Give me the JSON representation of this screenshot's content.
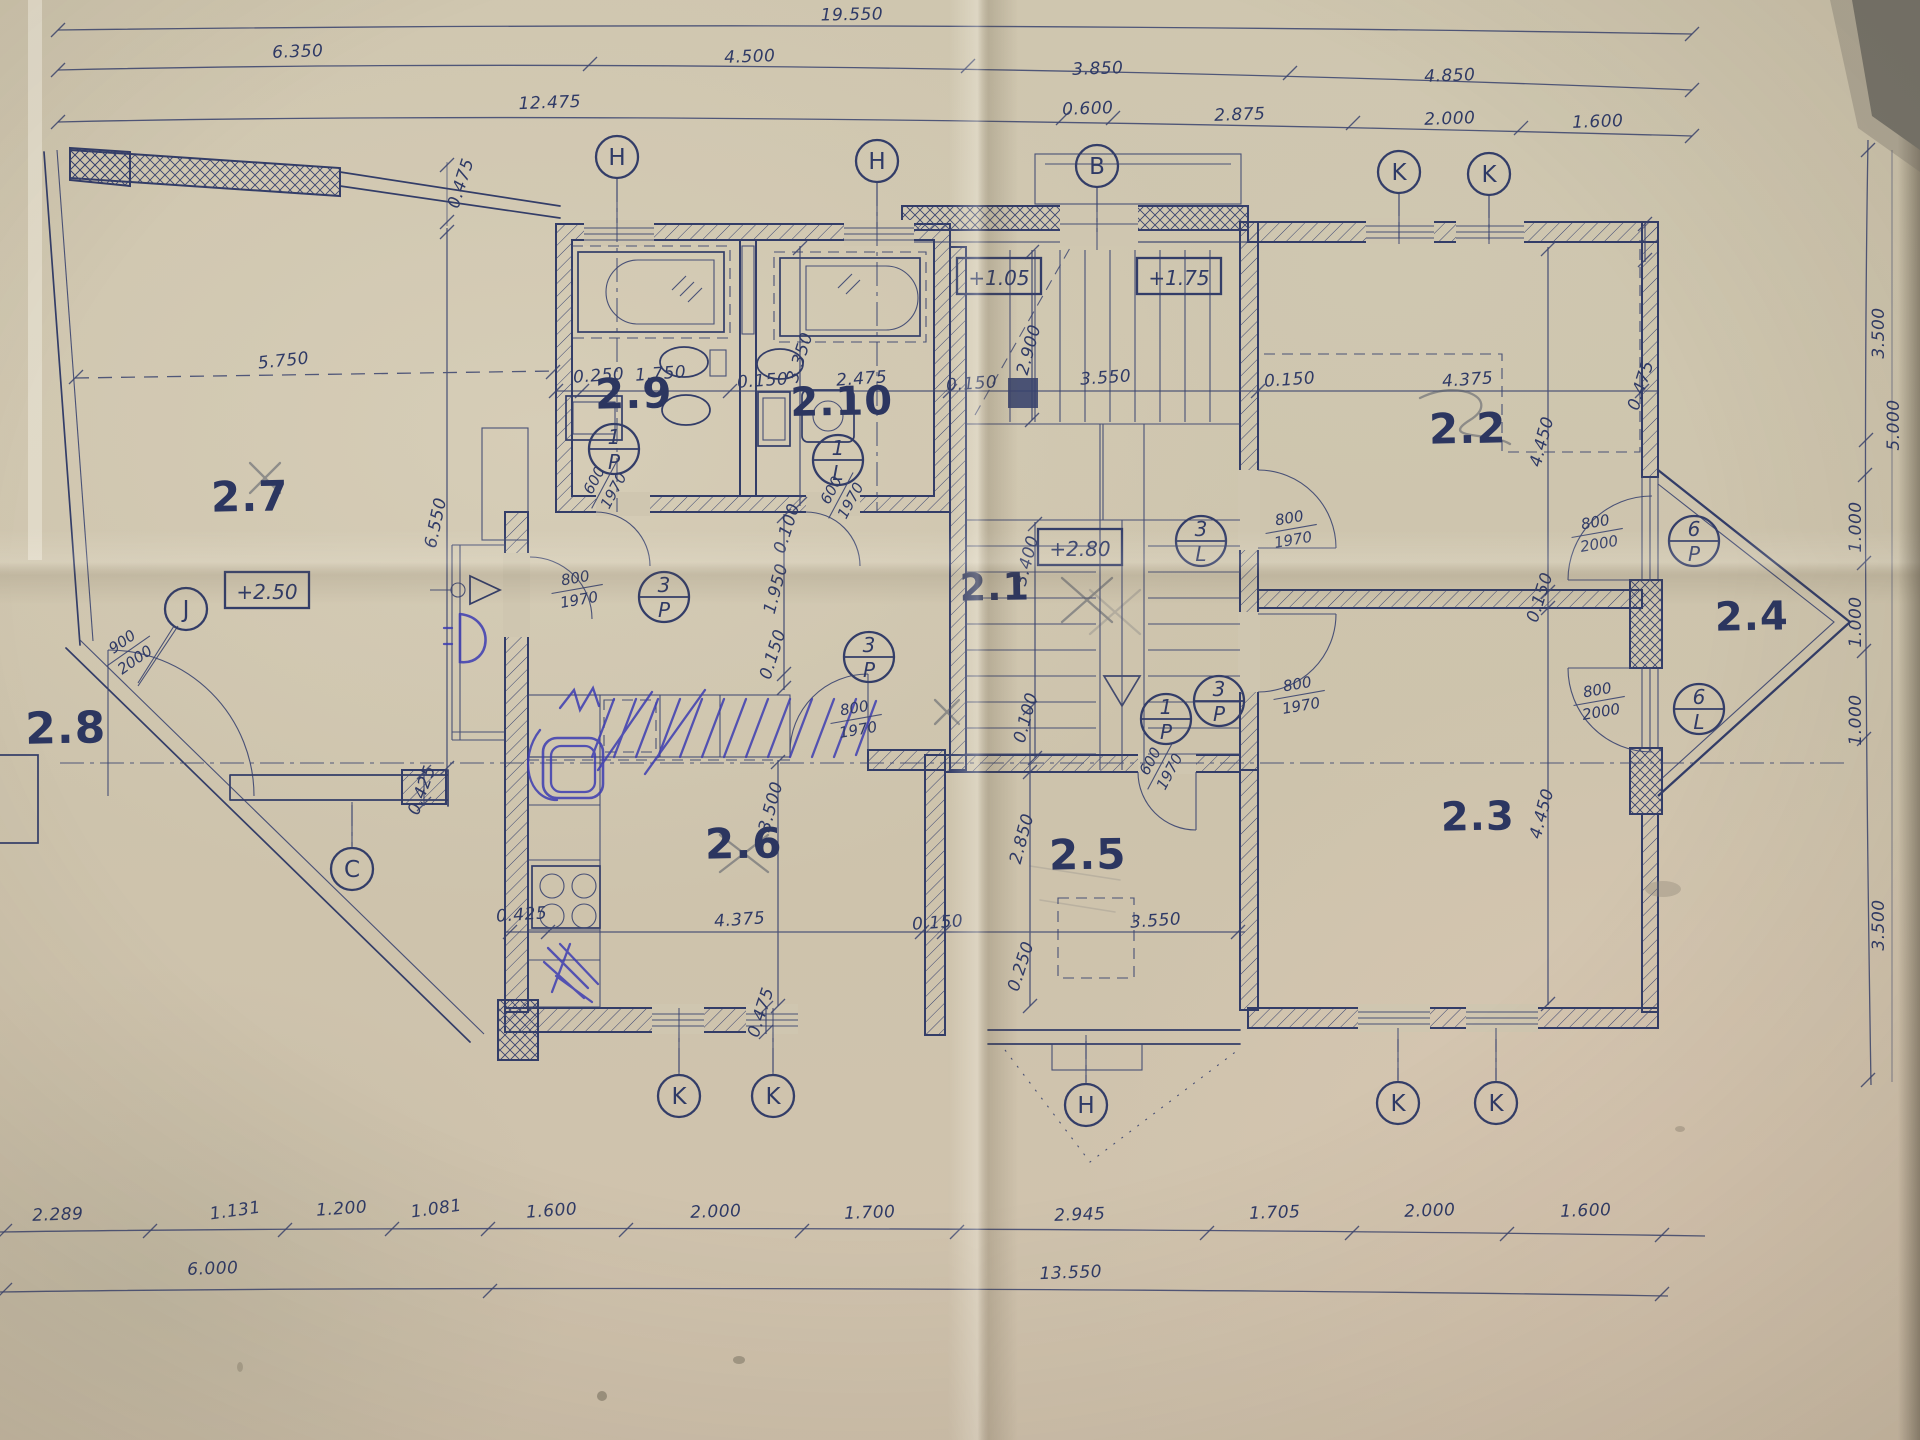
{
  "drawing": {
    "type": "architectural floor plan – storey 2, hand-drafted blueprint on aged paper",
    "ink_color": "#333d68",
    "paper_color": "#cdc4ae",
    "pen_annotation_color": "#3d3db2",
    "pencil_annotation_color": "#565b68"
  },
  "room_labels": [
    {
      "id": "2.1",
      "x": 995,
      "y": 600,
      "size": 38
    },
    {
      "id": "2.2",
      "x": 1468,
      "y": 443,
      "size": 42
    },
    {
      "id": "2.3",
      "x": 1478,
      "y": 830,
      "size": 40
    },
    {
      "id": "2.4",
      "x": 1752,
      "y": 630,
      "size": 40
    },
    {
      "id": "2.5",
      "x": 1088,
      "y": 869,
      "size": 42
    },
    {
      "id": "2.6",
      "x": 744,
      "y": 858,
      "size": 42
    },
    {
      "id": "2.7",
      "x": 250,
      "y": 511,
      "size": 42
    },
    {
      "id": "2.8",
      "x": 66,
      "y": 743,
      "size": 44
    },
    {
      "id": "2.9",
      "x": 634,
      "y": 408,
      "size": 42
    },
    {
      "id": "2.10",
      "x": 842,
      "y": 415,
      "size": 40
    }
  ],
  "grid_markers": [
    {
      "label": "H",
      "x": 617,
      "y": 157,
      "stem": "down"
    },
    {
      "label": "H",
      "x": 877,
      "y": 161,
      "stem": "down"
    },
    {
      "label": "B",
      "x": 1097,
      "y": 166,
      "stem": "down"
    },
    {
      "label": "K",
      "x": 1399,
      "y": 172,
      "stem": "down"
    },
    {
      "label": "K",
      "x": 1489,
      "y": 174,
      "stem": "down"
    },
    {
      "label": "J",
      "x": 186,
      "y": 609,
      "stem": "diag"
    },
    {
      "label": "C",
      "x": 352,
      "y": 869,
      "stem": "up"
    },
    {
      "label": "K",
      "x": 679,
      "y": 1096,
      "stem": "up"
    },
    {
      "label": "K",
      "x": 773,
      "y": 1096,
      "stem": "up"
    },
    {
      "label": "H",
      "x": 1086,
      "y": 1105,
      "stem": "up"
    },
    {
      "label": "K",
      "x": 1398,
      "y": 1103,
      "stem": "up"
    },
    {
      "label": "K",
      "x": 1496,
      "y": 1103,
      "stem": "up"
    }
  ],
  "elevation_markers": [
    {
      "label": "+1.05",
      "x": 999,
      "y": 277
    },
    {
      "label": "+1.75",
      "x": 1179,
      "y": 277
    },
    {
      "label": "+2.50",
      "x": 267,
      "y": 591
    },
    {
      "label": "+2.80",
      "x": 1080,
      "y": 548
    }
  ],
  "door_tags": [
    {
      "num": "1",
      "letter": "P",
      "x": 614,
      "y": 449
    },
    {
      "num": "1",
      "letter": "L",
      "x": 838,
      "y": 460
    },
    {
      "num": "3",
      "letter": "P",
      "x": 664,
      "y": 597
    },
    {
      "num": "3",
      "letter": "P",
      "x": 869,
      "y": 657
    },
    {
      "num": "3",
      "letter": "L",
      "x": 1201,
      "y": 541
    },
    {
      "num": "3",
      "letter": "P",
      "x": 1219,
      "y": 701
    },
    {
      "num": "1",
      "letter": "P",
      "x": 1166,
      "y": 719
    },
    {
      "num": "6",
      "letter": "P",
      "x": 1694,
      "y": 541
    },
    {
      "num": "6",
      "letter": "L",
      "x": 1699,
      "y": 709
    }
  ],
  "door_sizes": [
    {
      "top": "600",
      "bottom": "1970",
      "x": 603,
      "y": 485,
      "rot": -62
    },
    {
      "top": "600",
      "bottom": "1970",
      "x": 840,
      "y": 495,
      "rot": -62
    },
    {
      "top": "800",
      "bottom": "1970",
      "x": 577,
      "y": 588,
      "rot": -10
    },
    {
      "top": "800",
      "bottom": "1970",
      "x": 856,
      "y": 718,
      "rot": -10
    },
    {
      "top": "800",
      "bottom": "1970",
      "x": 1291,
      "y": 528,
      "rot": -10
    },
    {
      "top": "800",
      "bottom": "1970",
      "x": 1299,
      "y": 694,
      "rot": -10
    },
    {
      "top": "600",
      "bottom": "1970",
      "x": 1159,
      "y": 766,
      "rot": -62
    },
    {
      "top": "800",
      "bottom": "2000",
      "x": 1597,
      "y": 532,
      "rot": -10
    },
    {
      "top": "800",
      "bottom": "2000",
      "x": 1599,
      "y": 700,
      "rot": -10
    },
    {
      "top": "900",
      "bottom": "2000",
      "x": 128,
      "y": 650,
      "rot": -35
    }
  ],
  "dim_labels": [
    {
      "text": "19.550",
      "x": 852,
      "y": 20,
      "rot": -1
    },
    {
      "text": "6.350",
      "x": 298,
      "y": 57,
      "rot": -2
    },
    {
      "text": "4.500",
      "x": 750,
      "y": 62,
      "rot": -2
    },
    {
      "text": "3.850",
      "x": 1098,
      "y": 74,
      "rot": -2
    },
    {
      "text": "4.850",
      "x": 1450,
      "y": 81,
      "rot": -2
    },
    {
      "text": "12.475",
      "x": 550,
      "y": 108,
      "rot": -2
    },
    {
      "text": "0.600",
      "x": 1088,
      "y": 114,
      "rot": -2
    },
    {
      "text": "2.875",
      "x": 1240,
      "y": 120,
      "rot": -2
    },
    {
      "text": "2.000",
      "x": 1450,
      "y": 124,
      "rot": -2
    },
    {
      "text": "1.600",
      "x": 1598,
      "y": 127,
      "rot": -2
    },
    {
      "text": "0.475",
      "x": 466,
      "y": 185,
      "rot": -72
    },
    {
      "text": "5.750",
      "x": 284,
      "y": 366,
      "rot": -6
    },
    {
      "text": "6.550",
      "x": 441,
      "y": 524,
      "rot": -78
    },
    {
      "text": "0.425",
      "x": 427,
      "y": 792,
      "rot": -70
    },
    {
      "text": "0.425",
      "x": 522,
      "y": 920,
      "rot": -4
    },
    {
      "text": "0.250",
      "x": 599,
      "y": 381,
      "rot": -4
    },
    {
      "text": "1.750",
      "x": 661,
      "y": 379,
      "rot": -4
    },
    {
      "text": "0.150",
      "x": 763,
      "y": 386,
      "rot": -4
    },
    {
      "text": "3.350",
      "x": 805,
      "y": 359,
      "rot": -72
    },
    {
      "text": "2.475",
      "x": 862,
      "y": 384,
      "rot": -4
    },
    {
      "text": "0.100",
      "x": 792,
      "y": 530,
      "rot": -72
    },
    {
      "text": "2.900",
      "x": 1034,
      "y": 351,
      "rot": -75
    },
    {
      "text": "3.550",
      "x": 1106,
      "y": 383,
      "rot": -4
    },
    {
      "text": "0.150",
      "x": 972,
      "y": 389,
      "rot": -4
    },
    {
      "text": "0.150",
      "x": 1290,
      "y": 385,
      "rot": -4
    },
    {
      "text": "4.375",
      "x": 1468,
      "y": 385,
      "rot": -4
    },
    {
      "text": "0.475",
      "x": 1646,
      "y": 387,
      "rot": -72
    },
    {
      "text": "3.400",
      "x": 1032,
      "y": 562,
      "rot": -75
    },
    {
      "text": "1.950",
      "x": 781,
      "y": 590,
      "rot": -75
    },
    {
      "text": "0.150",
      "x": 778,
      "y": 656,
      "rot": -72
    },
    {
      "text": "0.100",
      "x": 1031,
      "y": 719,
      "rot": -75
    },
    {
      "text": "4.450",
      "x": 1547,
      "y": 443,
      "rot": -75
    },
    {
      "text": "0.150",
      "x": 1545,
      "y": 599,
      "rot": -72
    },
    {
      "text": "4.450",
      "x": 1547,
      "y": 815,
      "rot": -75
    },
    {
      "text": "2.850",
      "x": 1027,
      "y": 840,
      "rot": -75
    },
    {
      "text": "3.550",
      "x": 1156,
      "y": 926,
      "rot": -4
    },
    {
      "text": "0.250",
      "x": 1026,
      "y": 968,
      "rot": -72
    },
    {
      "text": "0.150",
      "x": 938,
      "y": 928,
      "rot": -4
    },
    {
      "text": "3.500",
      "x": 776,
      "y": 808,
      "rot": -75
    },
    {
      "text": "4.375",
      "x": 740,
      "y": 925,
      "rot": -4
    },
    {
      "text": "0.475",
      "x": 766,
      "y": 1014,
      "rot": -72
    },
    {
      "text": "2.289",
      "x": 58,
      "y": 1220,
      "rot": -2
    },
    {
      "text": "1.131",
      "x": 236,
      "y": 1216,
      "rot": -8
    },
    {
      "text": "1.200",
      "x": 342,
      "y": 1214,
      "rot": -4
    },
    {
      "text": "1.081",
      "x": 437,
      "y": 1214,
      "rot": -8
    },
    {
      "text": "1.600",
      "x": 552,
      "y": 1216,
      "rot": -4
    },
    {
      "text": "2.000",
      "x": 716,
      "y": 1217,
      "rot": -2
    },
    {
      "text": "1.700",
      "x": 870,
      "y": 1218,
      "rot": -2
    },
    {
      "text": "2.945",
      "x": 1080,
      "y": 1220,
      "rot": -2
    },
    {
      "text": "1.705",
      "x": 1275,
      "y": 1218,
      "rot": -2
    },
    {
      "text": "2.000",
      "x": 1430,
      "y": 1216,
      "rot": -2
    },
    {
      "text": "1.600",
      "x": 1586,
      "y": 1216,
      "rot": -2
    },
    {
      "text": "6.000",
      "x": 213,
      "y": 1274,
      "rot": -2
    },
    {
      "text": "13.550",
      "x": 1071,
      "y": 1278,
      "rot": -2
    },
    {
      "text": "3.500",
      "x": 1884,
      "y": 333,
      "rot": -90
    },
    {
      "text": "5.000",
      "x": 1899,
      "y": 425,
      "rot": -90
    },
    {
      "text": "1.000",
      "x": 1861,
      "y": 527,
      "rot": -90
    },
    {
      "text": "1.000",
      "x": 1861,
      "y": 622,
      "rot": -90
    },
    {
      "text": "1.000",
      "x": 1861,
      "y": 720,
      "rot": -90
    },
    {
      "text": "3.500",
      "x": 1884,
      "y": 925,
      "rot": -90
    }
  ]
}
